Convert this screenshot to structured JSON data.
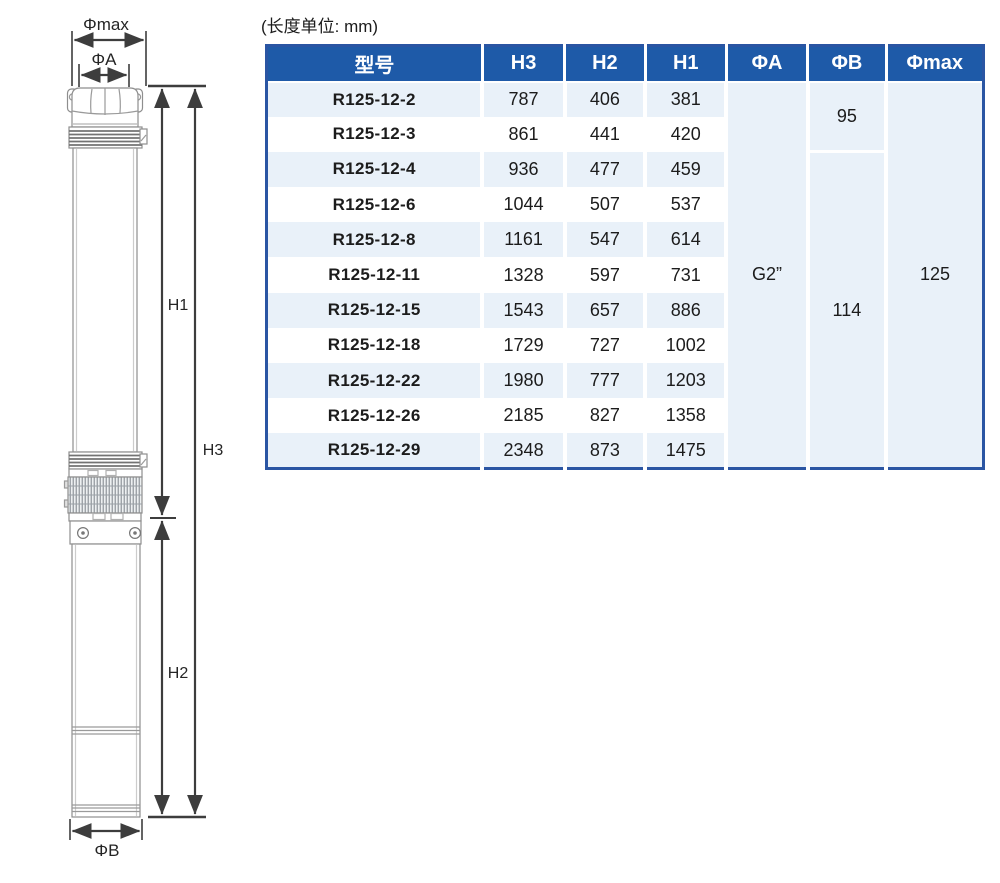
{
  "unit_note": "(长度单位: mm)",
  "diagram": {
    "phi_max_label": "Φmax",
    "phi_a_label": "ΦA",
    "phi_b_label": "ΦB",
    "h1_label": "H1",
    "h2_label": "H2",
    "h3_label": "H3"
  },
  "table": {
    "headers": [
      "型号",
      "H3",
      "H2",
      "H1",
      "ΦA",
      "ΦB",
      "Φmax"
    ],
    "rows": [
      {
        "model": "R125-12-2",
        "h3": "787",
        "h2": "406",
        "h1": "381"
      },
      {
        "model": "R125-12-3",
        "h3": "861",
        "h2": "441",
        "h1": "420"
      },
      {
        "model": "R125-12-4",
        "h3": "936",
        "h2": "477",
        "h1": "459"
      },
      {
        "model": "R125-12-6",
        "h3": "1044",
        "h2": "507",
        "h1": "537"
      },
      {
        "model": "R125-12-8",
        "h3": "1161",
        "h2": "547",
        "h1": "614"
      },
      {
        "model": "R125-12-11",
        "h3": "1328",
        "h2": "597",
        "h1": "731"
      },
      {
        "model": "R125-12-15",
        "h3": "1543",
        "h2": "657",
        "h1": "886"
      },
      {
        "model": "R125-12-18",
        "h3": "1729",
        "h2": "727",
        "h1": "1002"
      },
      {
        "model": "R125-12-22",
        "h3": "1980",
        "h2": "777",
        "h1": "1203"
      },
      {
        "model": "R125-12-26",
        "h3": "2185",
        "h2": "827",
        "h1": "1358"
      },
      {
        "model": "R125-12-29",
        "h3": "2348",
        "h2": "873",
        "h1": "1475"
      }
    ],
    "merged": {
      "phi_a": "G2”",
      "phi_b_top": "95",
      "phi_b_bottom": "114",
      "phi_max": "125"
    }
  },
  "colors": {
    "header_bg": "#1e5aa8",
    "row_alt_bg": "#e9f1f9",
    "table_border": "#2a55a3",
    "text": "#1c1c1c",
    "dim_line": "#3d3d3d"
  }
}
